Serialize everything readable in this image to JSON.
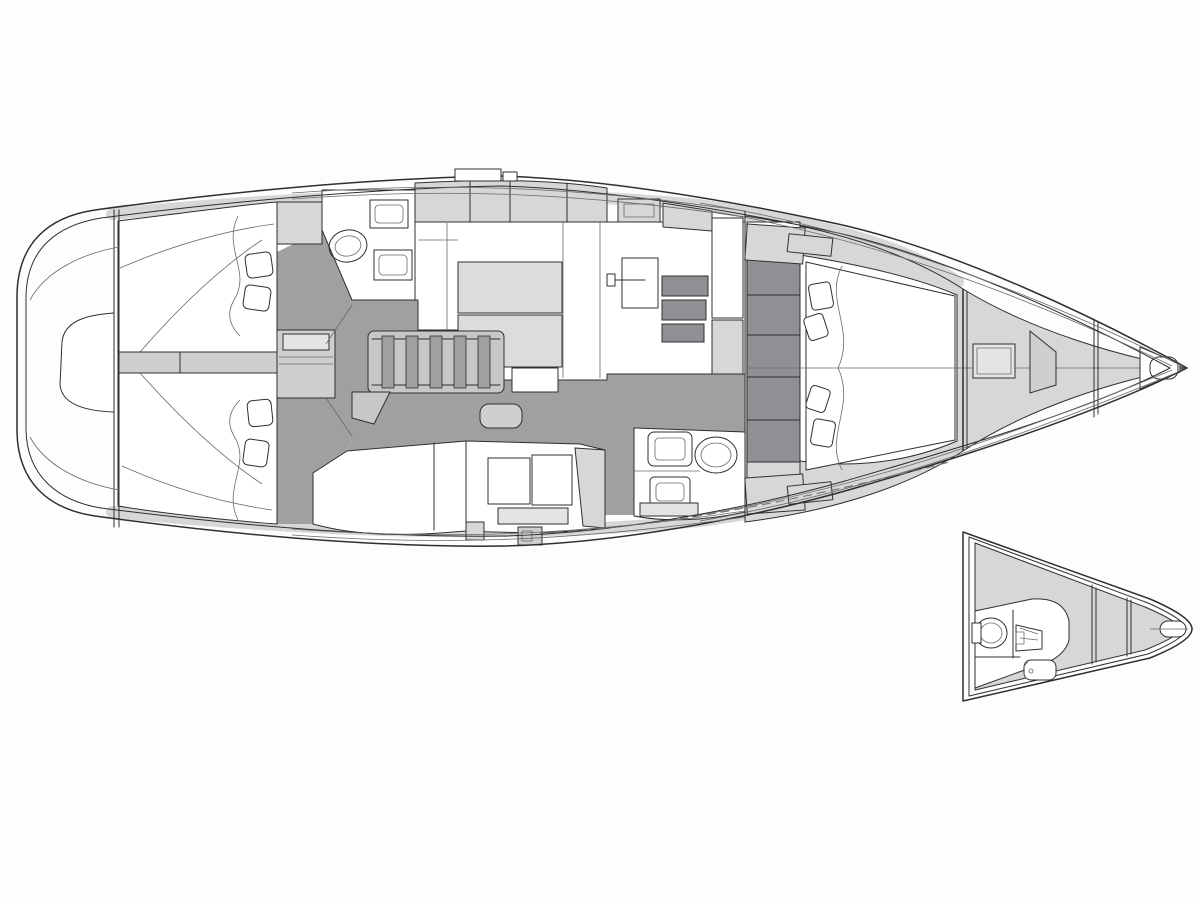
{
  "meta": {
    "title": "Sailing yacht interior layout plan — top view, bow to the right, with alternative bow head inset",
    "view_main_label": "Main interior layout",
    "view_inset_label": "Bow option with extra head"
  },
  "palette": {
    "background": "#fdfdfd",
    "line": "#2f2f2f",
    "line_soft": "#6a6a6a",
    "white": "#ffffff",
    "deck_light": "#d7d7d7",
    "panel_light": "#cfcfcf",
    "panel_inner": "#e4e4e4",
    "table_light": "#dcdcdc",
    "floor_mid": "#a0a0a0",
    "locker_dark": "#8e9094",
    "step_light": "#c7c7c7"
  },
  "regions": [
    {
      "id": "stern-platform",
      "label": "Stern swim platform"
    },
    {
      "id": "port-aft-cabin",
      "label": "Port aft double cabin"
    },
    {
      "id": "starboard-aft-cabin",
      "label": "Starboard aft double cabin"
    },
    {
      "id": "walkthrough",
      "label": "Aft walkthrough / engine box"
    },
    {
      "id": "port-head",
      "label": "Port aft head (toilet + sinks)"
    },
    {
      "id": "companionway-steps",
      "label": "Companionway steps"
    },
    {
      "id": "salon",
      "label": "Salon with U-settee and table"
    },
    {
      "id": "nav-station",
      "label": "Chart table / nav station"
    },
    {
      "id": "galley",
      "label": "Galley counters"
    },
    {
      "id": "starboard-head",
      "label": "Forward head (toilet + sinks)"
    },
    {
      "id": "forward-cabin",
      "label": "Owner forward cabin with island berth"
    },
    {
      "id": "bow-lockers",
      "label": "Bow sail locker and anchor compartments"
    },
    {
      "id": "bow-inset",
      "label": "Inset: alternative bow layout with crew head"
    }
  ]
}
